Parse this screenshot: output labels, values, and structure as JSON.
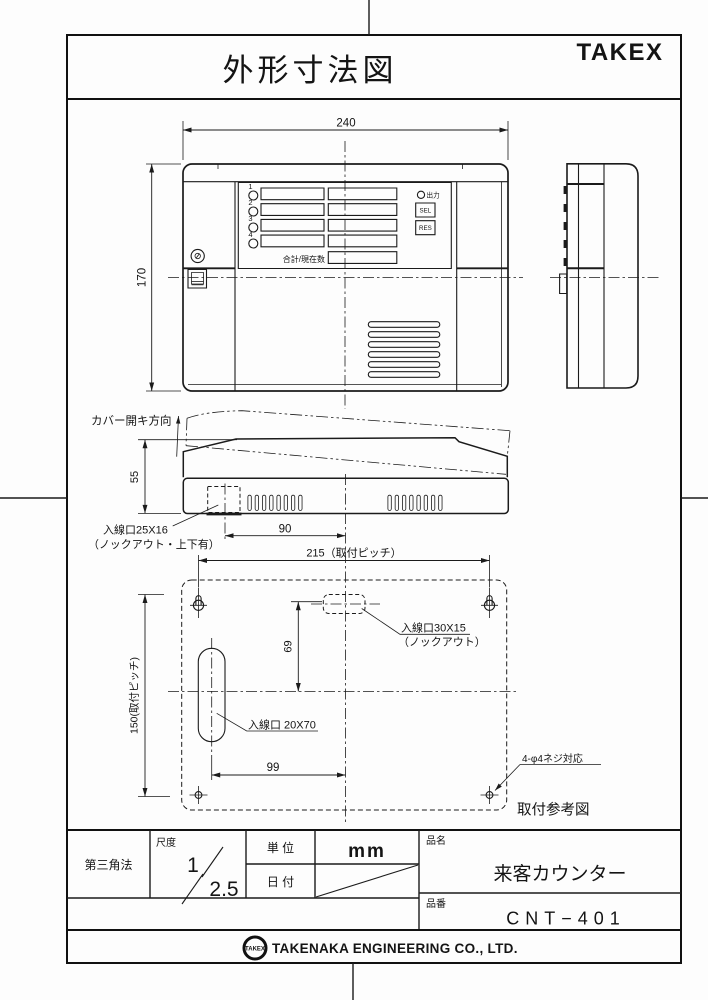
{
  "sheet": {
    "title": "外形寸法図",
    "brand": "TAKEX"
  },
  "front_view": {
    "dim_width": "240",
    "dim_height": "170",
    "led_numbers": [
      "1",
      "2",
      "3",
      "4"
    ],
    "output_label": "出力",
    "sel_button": "SEL",
    "res_button": "RES",
    "counter_label": "合計/現在数"
  },
  "profile_view": {
    "cover_direction_label": "カバー開キ方向",
    "dim_depth": "55",
    "dim_90": "90",
    "inlet_label": "入線口25X16",
    "inlet_note": "（ノックアウト・上下有）"
  },
  "mounting_view": {
    "dim_pitch_h": "215（取付ピッチ）",
    "dim_pitch_v": "150(取付ピッチ)",
    "dim_69": "69",
    "dim_99": "99",
    "inlet_top_label": "入線口30X15",
    "inlet_top_note": "（ノックアウト）",
    "inlet_left_label": "入線口 20X70",
    "screw_label": "4-φ4ネジ対応",
    "caption": "取付参考図"
  },
  "title_block": {
    "projection": "第三角法",
    "scale_label": "尺度",
    "scale_num": "1",
    "scale_den": "2.5",
    "unit_label": "単 位",
    "unit_value": "mm",
    "date_label": "日 付",
    "name_label": "品名",
    "name_value": "来客カウンター",
    "number_label": "品番",
    "number_value": "CNT−401"
  },
  "footer": {
    "logo": "TAKEX",
    "company": "TAKENAKA ENGINEERING CO., LTD."
  }
}
